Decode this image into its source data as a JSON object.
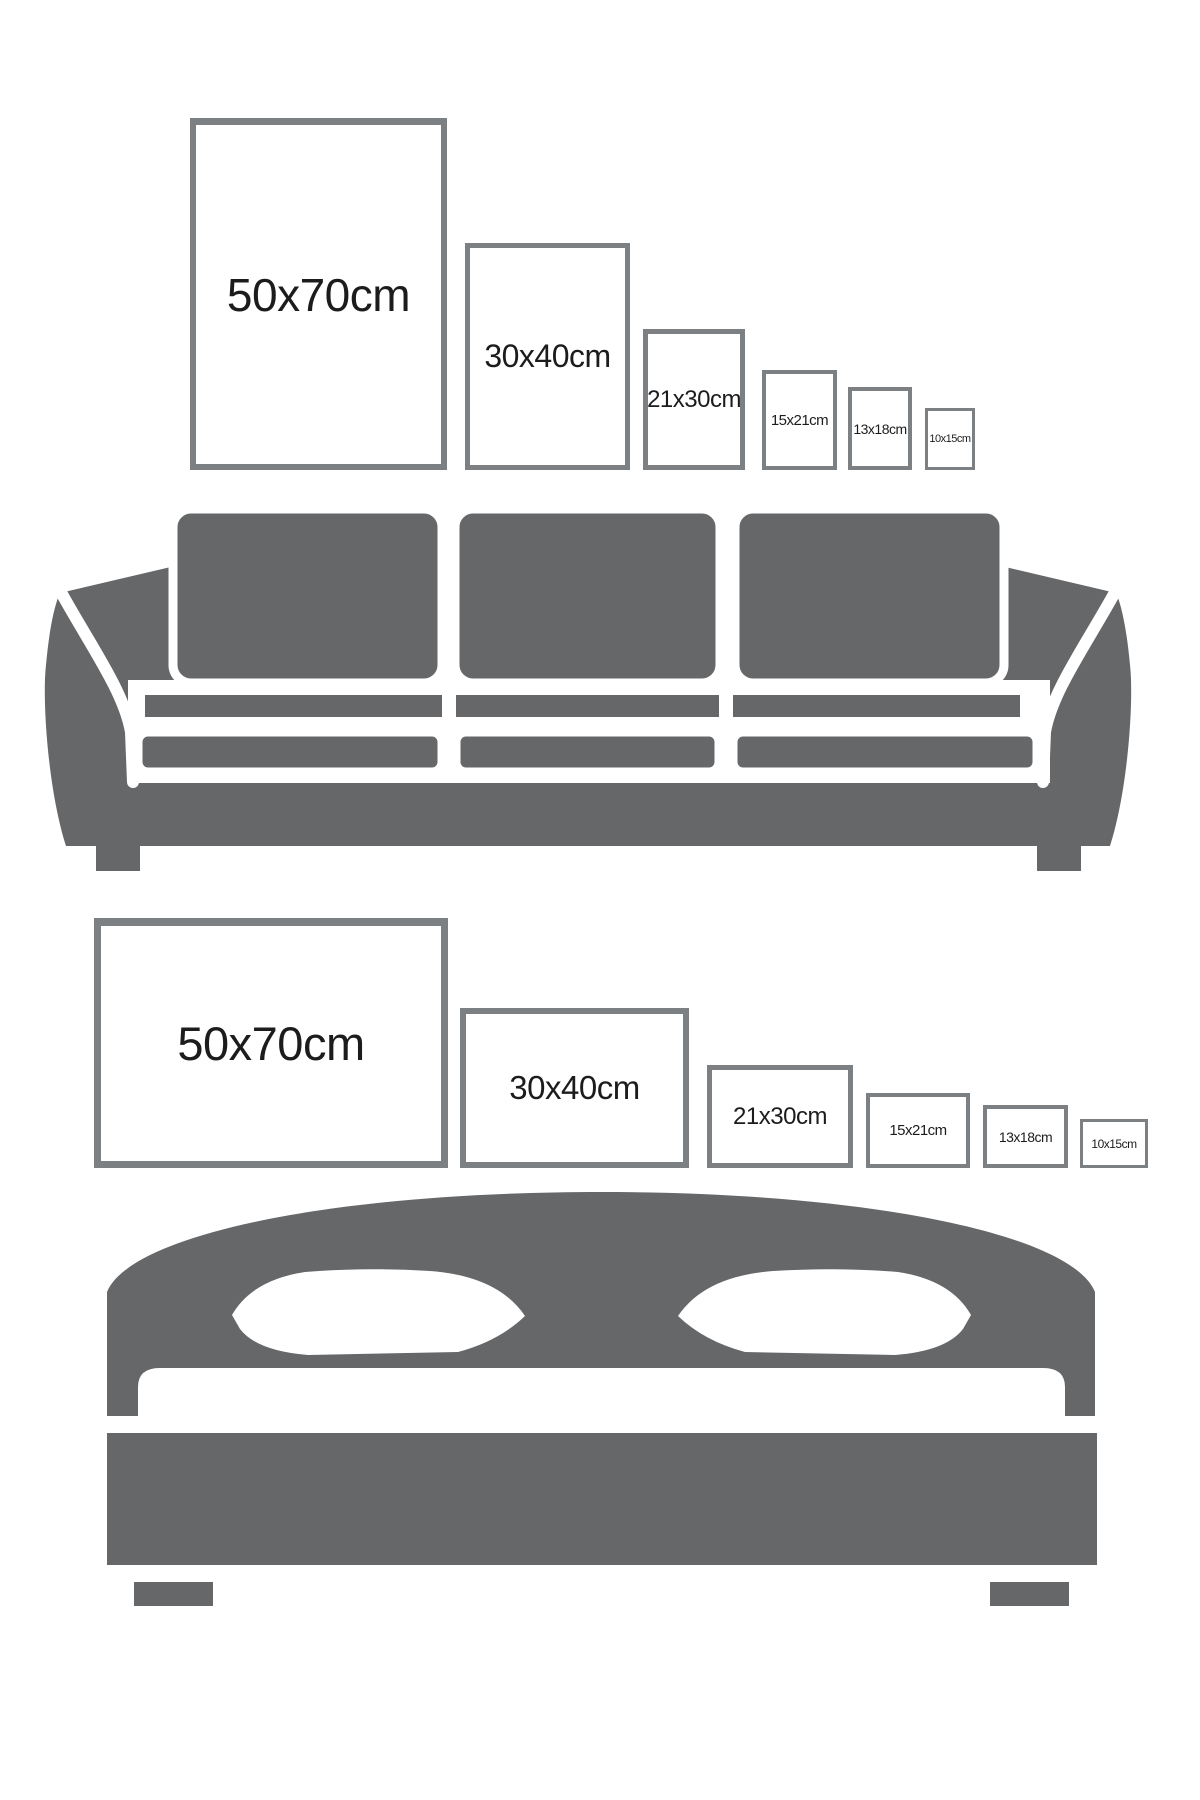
{
  "colors": {
    "furniture": "#666769",
    "frame_border": "#7d8083",
    "text": "#1c1c1c",
    "background": "#ffffff"
  },
  "sofa_scene": {
    "furniture": "sofa",
    "orientation": "portrait",
    "frames": [
      {
        "label": "50x70cm"
      },
      {
        "label": "30x40cm"
      },
      {
        "label": "21x30cm"
      },
      {
        "label": "15x21cm"
      },
      {
        "label": "13x18cm"
      },
      {
        "label": "10x15cm"
      }
    ]
  },
  "bed_scene": {
    "furniture": "bed",
    "orientation": "landscape",
    "frames": [
      {
        "label": "50x70cm"
      },
      {
        "label": "30x40cm"
      },
      {
        "label": "21x30cm"
      },
      {
        "label": "15x21cm"
      },
      {
        "label": "13x18cm"
      },
      {
        "label": "10x15cm"
      }
    ]
  }
}
